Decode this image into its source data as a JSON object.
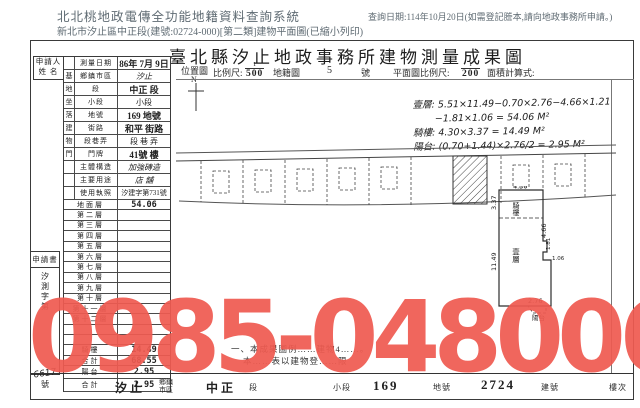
{
  "page": {
    "system_title": "北北桃地政電傳全功能地籍資料查詢系統",
    "subtitle": "新北市汐止區中正段(建號:02724-000)[第二類]建物平面圖(已縮小列印)",
    "query_date": "查詢日期:114年10月20日(如需登記謄本,請向地政事務所申請。)"
  },
  "watermark": {
    "text": "0985-048006",
    "color": "#ef5b51"
  },
  "form": {
    "title": "臺北縣汐止地政事務所建物測量成果圖",
    "scale_row": {
      "location_map": "位置圖",
      "north": "N",
      "scale_label": "比例尺:",
      "loc_num": "1",
      "loc_den": "500",
      "cadastral": "地籍圖",
      "sheet": "5",
      "sheet_suffix": "號",
      "plan_scale_label": "平面圖比例尺:",
      "plan_num": "1",
      "plan_den": "200",
      "area_label": "面積計算式:"
    },
    "applicant_label_1": "申請人",
    "applicant_label_2": "姓  名",
    "info_rows": [
      {
        "group": "",
        "label": "測量日期",
        "value": "86年 7月 9日"
      },
      {
        "group": "基",
        "label": "鄉鎮市區",
        "value": "汐止"
      },
      {
        "group": "地",
        "label": "段",
        "value": "中正 段"
      },
      {
        "group": "坐",
        "label": "小段",
        "value": "小段"
      },
      {
        "group": "落",
        "label": "地號",
        "value": "169 地號"
      },
      {
        "group": "建",
        "label": "街路",
        "value": "和平 街路"
      },
      {
        "group": "物",
        "label": "段巷弄",
        "value": "段 巷 弄"
      },
      {
        "group": "門",
        "label": "門牌",
        "value": "41號 樓"
      },
      {
        "group": "",
        "label": "主體構造",
        "value": "加強磚造"
      },
      {
        "group": "",
        "label": "主要用途",
        "value": "店 舖"
      },
      {
        "group": "",
        "label": "使用執照",
        "value": "汐建字第731號"
      }
    ],
    "floor_rows": [
      {
        "label": "地面層",
        "value": "54.06"
      },
      {
        "label": "第二層",
        "value": ""
      },
      {
        "label": "第三層",
        "value": ""
      },
      {
        "label": "第四層",
        "value": ""
      },
      {
        "label": "第五層",
        "value": ""
      },
      {
        "label": "第六層",
        "value": ""
      },
      {
        "label": "第七層",
        "value": ""
      },
      {
        "label": "第八層",
        "value": ""
      },
      {
        "label": "第九層",
        "value": ""
      },
      {
        "label": "第十層",
        "value": ""
      },
      {
        "label": "第十一層",
        "value": ""
      },
      {
        "label": "第十二層",
        "value": ""
      },
      {
        "label": "",
        "value": ""
      },
      {
        "label": "",
        "value": ""
      },
      {
        "label": "騎樓",
        "value": "14.49"
      },
      {
        "label": "合計",
        "value": "68.55"
      }
    ],
    "annex_rows": [
      {
        "label": "陽台",
        "value": "2.95"
      },
      {
        "label": "合計",
        "value": "2.95"
      }
    ],
    "application": {
      "header": "申請書",
      "doc_prefix": "汐測字第",
      "doc_no": "6617",
      "doc_suffix": "號"
    },
    "area_calc_lines": [
      "壹層: 5.51×11.49−0.70×2.76−4.66×1.21",
      "−1.81×1.06 = 54.06 M²",
      "騎樓: 4.30×3.37 = 14.49 M²",
      "陽台: (0.70+1.44)×2.76/2 = 2.95 M²"
    ],
    "plan": {
      "top": "4.30",
      "left_top": "3.37",
      "arcade": "騎樓",
      "right_top": "4.66",
      "main": "壹層",
      "left": "11.49",
      "r1": "1.81",
      "r2": "1.06",
      "bottom": "2.76",
      "balcony": "陽台"
    },
    "notes": [
      "一、本成果圖例……建物4……。",
      "本……表以建物登……限"
    ],
    "bottom_bar": {
      "district": "汐止",
      "district_label_1": "鄉鎮",
      "district_label_2": "市區",
      "section": "中正",
      "section_label": "段",
      "subsection_label": "小段",
      "land_no": "169",
      "land_label": "地號",
      "building_no": "2724",
      "building_label": "建號",
      "floor_label": "樓次"
    }
  }
}
